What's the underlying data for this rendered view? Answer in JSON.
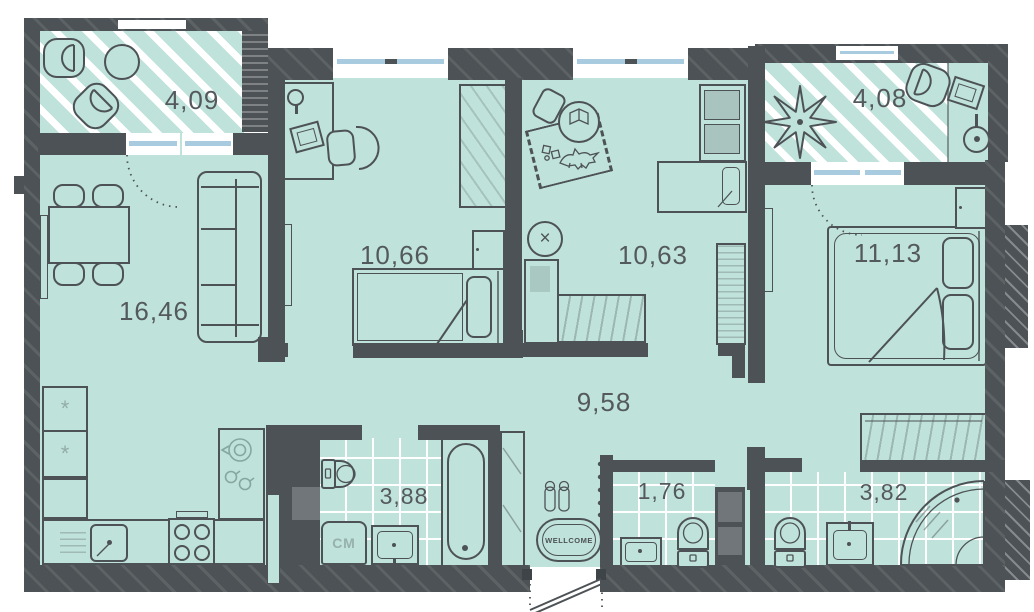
{
  "rooms": {
    "living_room": {
      "name": "living room / kitchen",
      "area": "16,46"
    },
    "bedroom_1": {
      "name": "bedroom 1",
      "area": "10,66"
    },
    "nursery": {
      "name": "children's room",
      "area": "10,63"
    },
    "bedroom_2": {
      "name": "bedroom 2",
      "area": "11,13"
    },
    "hallway": {
      "name": "hallway",
      "area": "9,58"
    },
    "bathroom": {
      "name": "bathroom",
      "area": "3,88"
    },
    "wc": {
      "name": "wc",
      "area": "1,76"
    },
    "shower_room": {
      "name": "shower room",
      "area": "3,82"
    },
    "balcony_left": {
      "name": "balcony left",
      "area": "4,09"
    },
    "balcony_right": {
      "name": "balcony right",
      "area": "4,08"
    }
  },
  "labels": {
    "washing_machine": "СМ",
    "doormat": "WELLCOME"
  },
  "icons": {
    "snowflake": "*",
    "stool_cross": "×"
  },
  "colors": {
    "floor": "#bfe2da",
    "wall": "#4d5256",
    "wall-light": "#70767a",
    "glazing": "#a9cbdf",
    "line": "#4d5256",
    "line-light": "#85a79f",
    "label": "#54595d"
  }
}
